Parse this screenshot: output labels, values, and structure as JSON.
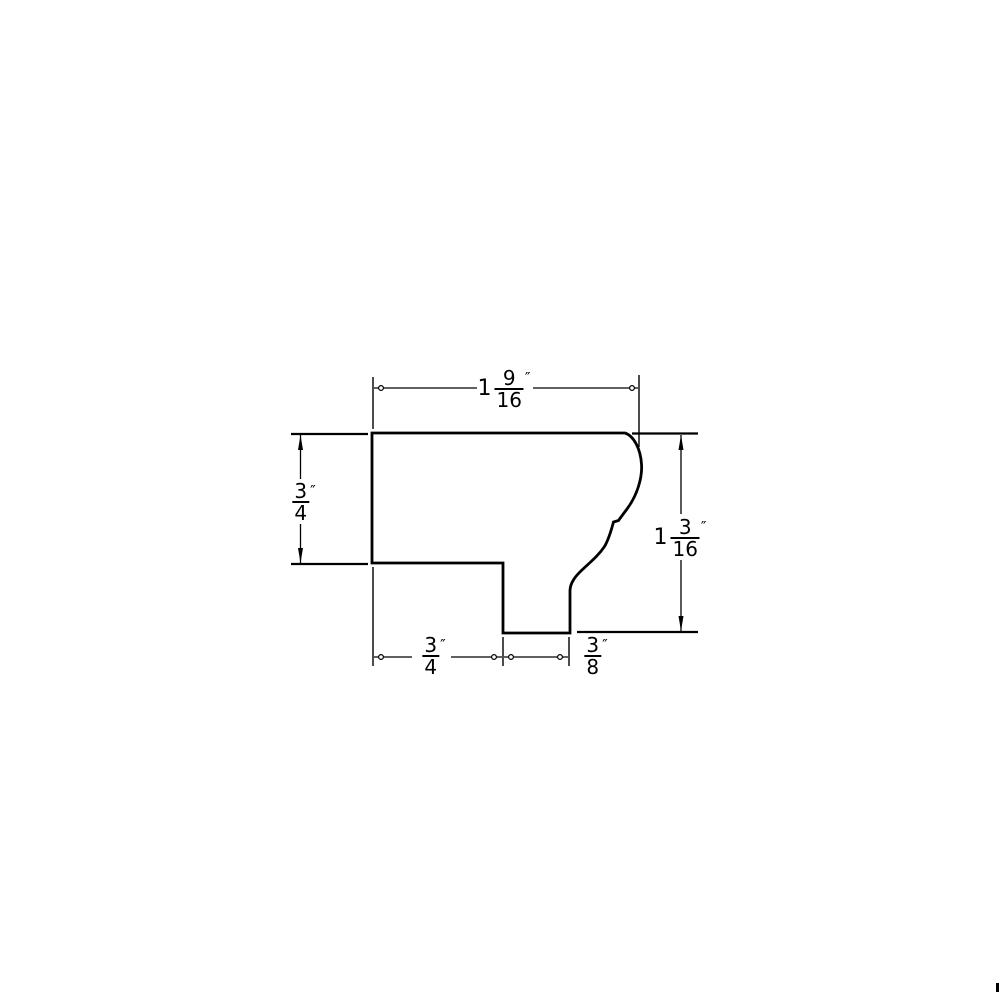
{
  "page": {
    "background": "#ffffff",
    "line_color": "#000000"
  },
  "drawing": {
    "type": "molding-profile-cross-section",
    "dimensions": {
      "top_width": {
        "whole": "1",
        "numerator": "9",
        "denominator": "16",
        "unit": "″"
      },
      "left_height": {
        "whole": "",
        "numerator": "3",
        "denominator": "4",
        "unit": "″"
      },
      "right_height": {
        "whole": "1",
        "numerator": "3",
        "denominator": "16",
        "unit": "″"
      },
      "bottom_left_width": {
        "whole": "",
        "numerator": "3",
        "denominator": "4",
        "unit": "″"
      },
      "bottom_notch_width": {
        "whole": "",
        "numerator": "3",
        "denominator": "8",
        "unit": "″"
      }
    }
  }
}
